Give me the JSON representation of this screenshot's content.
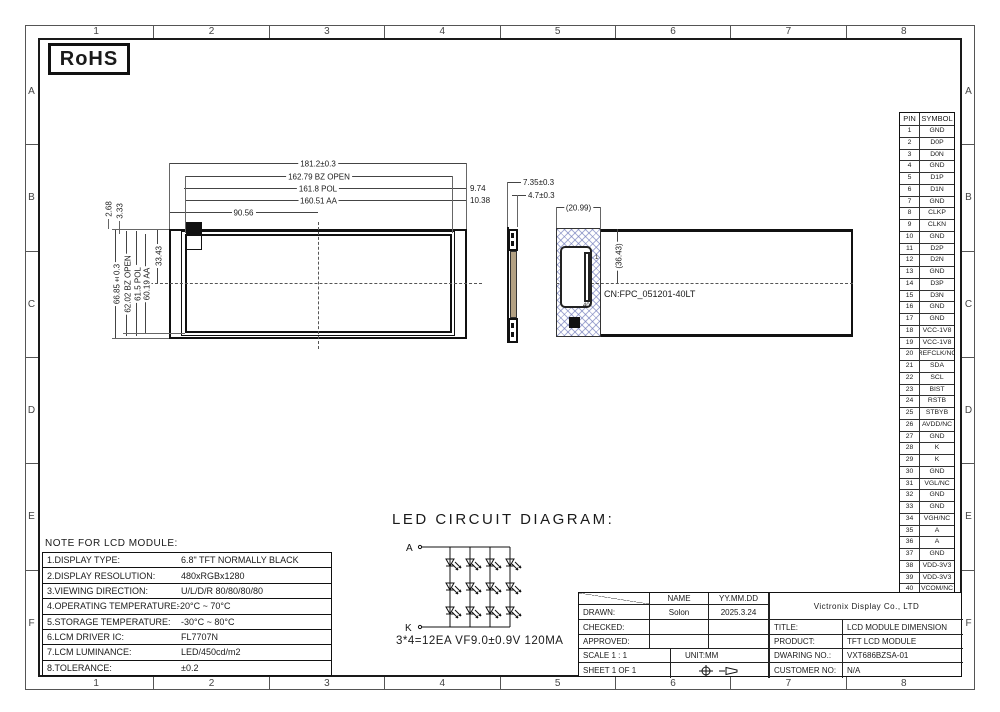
{
  "sheet": {
    "grid_cols": [
      "1",
      "2",
      "3",
      "4",
      "5",
      "6",
      "7",
      "8"
    ],
    "grid_rows": [
      "A",
      "B",
      "C",
      "D",
      "E",
      "F"
    ],
    "rohs_label": "RoHS"
  },
  "colors": {
    "line": "#1a1a1a",
    "hatch_blue": "#6e78b9",
    "backlight_tan": "#b3a183"
  },
  "main_view": {
    "dims_top": {
      "overall": "181.2±0.3",
      "bz_open": "162.79 BZ OPEN",
      "pol": "161.8 POL",
      "aa": "160.51 AA",
      "center": "90.56",
      "edge_pol": "9.74",
      "edge_aa": "10.38"
    },
    "dims_left": {
      "overall": "66.85±0.3",
      "bz_open": "62.02 BZ OPEN",
      "pol": "61.5 POL",
      "aa": "60.19 AA",
      "center": "33.43",
      "comp1": "2.68",
      "comp2": "3.33"
    }
  },
  "side_view": {
    "thickness": "7.35±0.3",
    "partial": "4.7±0.3"
  },
  "detail_view": {
    "width": "(20.99)",
    "height": "(36.43)",
    "connector_label": "CN:FPC_051201-40LT",
    "pin_first": "1",
    "pin_last": "40"
  },
  "pin_table": {
    "headers": [
      "PIN",
      "SYMBOL"
    ],
    "rows": [
      [
        "1",
        "GND"
      ],
      [
        "2",
        "D0P"
      ],
      [
        "3",
        "D0N"
      ],
      [
        "4",
        "GND"
      ],
      [
        "5",
        "D1P"
      ],
      [
        "6",
        "D1N"
      ],
      [
        "7",
        "GND"
      ],
      [
        "8",
        "CLKP"
      ],
      [
        "9",
        "CLKN"
      ],
      [
        "10",
        "GND"
      ],
      [
        "11",
        "D2P"
      ],
      [
        "12",
        "D2N"
      ],
      [
        "13",
        "GND"
      ],
      [
        "14",
        "D3P"
      ],
      [
        "15",
        "D3N"
      ],
      [
        "16",
        "GND"
      ],
      [
        "17",
        "GND"
      ],
      [
        "18",
        "VCC-1V8"
      ],
      [
        "19",
        "VCC-1V8"
      ],
      [
        "20",
        "REFCLK/NC"
      ],
      [
        "21",
        "SDA"
      ],
      [
        "22",
        "SCL"
      ],
      [
        "23",
        "BIST"
      ],
      [
        "24",
        "RSTB"
      ],
      [
        "25",
        "STBYB"
      ],
      [
        "26",
        "AVDD/NC"
      ],
      [
        "27",
        "GND"
      ],
      [
        "28",
        "K"
      ],
      [
        "29",
        "K"
      ],
      [
        "30",
        "GND"
      ],
      [
        "31",
        "VGL/NC"
      ],
      [
        "32",
        "GND"
      ],
      [
        "33",
        "GND"
      ],
      [
        "34",
        "VGH/NC"
      ],
      [
        "35",
        "A"
      ],
      [
        "36",
        "A"
      ],
      [
        "37",
        "GND"
      ],
      [
        "38",
        "VDD-3V3"
      ],
      [
        "39",
        "VDD-3V3"
      ],
      [
        "40",
        "VCOM/NC"
      ]
    ]
  },
  "led_diagram": {
    "title": "LED CIRCUIT DIAGRAM:",
    "anode": "A",
    "cathode": "K",
    "annotation": "3*4=12EA VF9.0±0.9V 120MA"
  },
  "notes": {
    "title": "NOTE FOR LCD MODULE:",
    "rows": [
      {
        "label": "1.DISPLAY TYPE:",
        "value": "6.8\" TFT NORMALLY BLACK"
      },
      {
        "label": "2.DISPLAY RESOLUTION:",
        "value": "480xRGBx1280"
      },
      {
        "label": "3.VIEWING DIRECTION:",
        "value": "U/L/D/R 80/80/80/80"
      },
      {
        "label": "4.OPERATING TEMPERATURE:",
        "value": "-20°C ~ 70°C"
      },
      {
        "label": "5.STORAGE TEMPERATURE:",
        "value": "-30°C ~ 80°C"
      },
      {
        "label": "6.LCM DRIVER IC:",
        "value": "FL7707N"
      },
      {
        "label": "7.LCM LUMINANCE:",
        "value": "LED/450cd/m2"
      },
      {
        "label": "8.TOLERANCE:",
        "value": "±0.2"
      }
    ]
  },
  "title_block": {
    "name_header": "NAME",
    "date_header": "YY.MM.DD",
    "drawn_label": "DRAWN:",
    "drawn_name": "Solon",
    "drawn_date": "2025.3.24",
    "checked_label": "CHECKED:",
    "approved_label": "APPROVED:",
    "scale": "SCALE 1 : 1",
    "unit": "UNIT:MM",
    "sheet": "SHEET 1 OF 1",
    "company": "Victronix Display Co., LTD",
    "title_label": "TITLE:",
    "title_value": "LCD MODULE DIMENSION",
    "product_label": "PRODUCT:",
    "product_value": "TFT LCD MODULE",
    "drawing_label": "DWARING NO.:",
    "drawing_value": "VXT686BZSA-01",
    "customer_label": "CUSTOMER NO:",
    "customer_value": "N/A"
  }
}
